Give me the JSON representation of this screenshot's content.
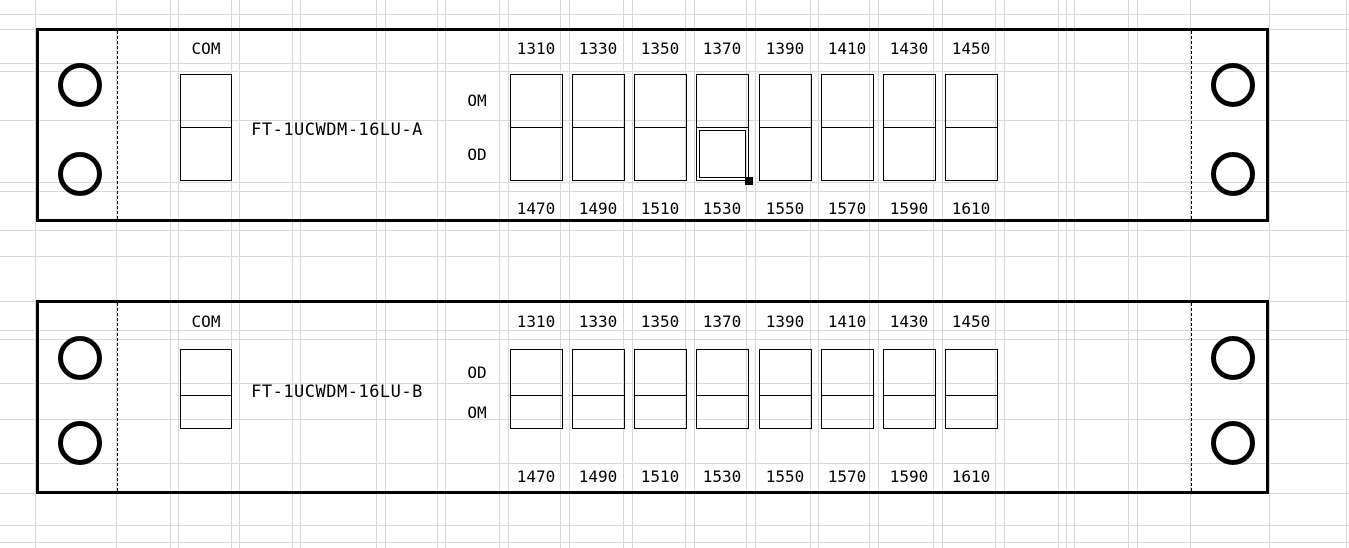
{
  "colors": {
    "line": "#000000",
    "grid": "#d8d8d8",
    "background": "#ffffff",
    "selection_handle": "#000000"
  },
  "panels": [
    {
      "name": "FT-1UCWDM-16LU-A",
      "com_label": "COM",
      "port_row_labels": [
        "OM",
        "OD"
      ],
      "top_wavelengths": [
        "1310",
        "1330",
        "1350",
        "1370",
        "1390",
        "1410",
        "1430",
        "1450"
      ],
      "bottom_wavelengths": [
        "1470",
        "1490",
        "1510",
        "1530",
        "1550",
        "1570",
        "1590",
        "1610"
      ]
    },
    {
      "name": "FT-1UCWDM-16LU-B",
      "com_label": "COM",
      "port_row_labels": [
        "OD",
        "OM"
      ],
      "top_wavelengths": [
        "1310",
        "1330",
        "1350",
        "1370",
        "1390",
        "1410",
        "1430",
        "1450"
      ],
      "bottom_wavelengths": [
        "1470",
        "1490",
        "1510",
        "1530",
        "1550",
        "1570",
        "1590",
        "1610"
      ]
    }
  ],
  "selection": {
    "panel": "FT-1UCWDM-16LU-A",
    "row": "OD",
    "column_wavelength_top": "1370",
    "column_wavelength_bottom": "1530"
  }
}
